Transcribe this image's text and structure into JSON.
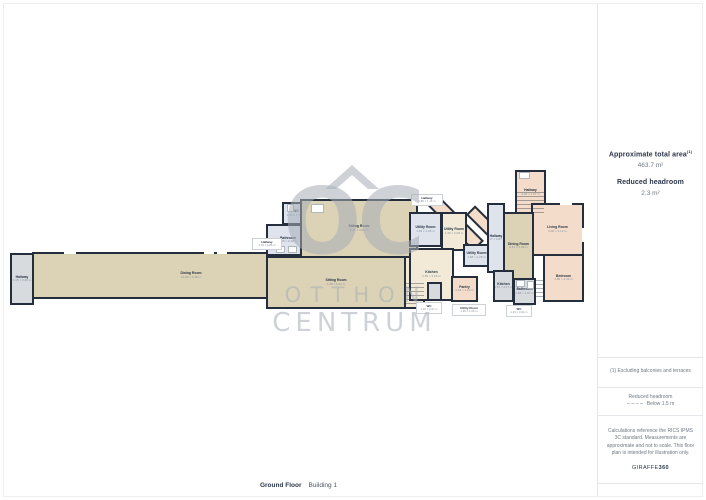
{
  "sidebar": {
    "total_area_label": "Approximate total area",
    "total_area_superscript": "(1)",
    "total_area_value": "463.7 m²",
    "reduced_headroom_label": "Reduced headroom",
    "reduced_headroom_value": "2.3 m²",
    "footnote": "(1) Excluding balconies and terraces",
    "legend_title": "Reduced headroom",
    "legend_value": "Below 1.5 m",
    "disclaimer": "Calculations reference the RICS IPMS 3C standard. Measurements are approximate and not to scale. This floor plan is intended for illustration only.",
    "brand_regular": "GIRAFFE",
    "brand_bold": "360"
  },
  "footer": {
    "floor_label": "Ground Floor",
    "building_label": "Building 1"
  },
  "watermark": {
    "initials": "OC",
    "line1": "OTTHON",
    "line2": "CENTRUM"
  },
  "floorplan": {
    "wall_color": "#242e3d",
    "fills": {
      "tan": "#dcd3b6",
      "blue": "#dee3ec",
      "gray": "#d8dbde",
      "cream": "#f2ead6",
      "pink": "#f3dcc9",
      "dkpeach": "#d3a890"
    },
    "rooms": [
      {
        "name": "diagonal-hallway-1",
        "label": "",
        "dims": "",
        "x": 424,
        "y": 216,
        "w": 64,
        "h": 15,
        "fill": "pink",
        "rot": 45,
        "z": 0
      },
      {
        "name": "diagonal-hallway-2",
        "label": "",
        "dims": "",
        "x": 462,
        "y": 224,
        "w": 58,
        "h": 13,
        "fill": "pink",
        "rot": 45,
        "z": 0
      },
      {
        "name": "hallway-far-left",
        "label": "Hallway",
        "dims": "1.05 × 3.29 m",
        "x": 10,
        "y": 253,
        "w": 24,
        "h": 52,
        "fill": "gray"
      },
      {
        "name": "corridor-long",
        "label": "Dining Room",
        "dims": "21.05 × 3.48 m",
        "x": 32,
        "y": 252,
        "w": 238,
        "h": 47,
        "fill": "tan",
        "lox": 40
      },
      {
        "name": "wc-left",
        "label": "WC",
        "dims": "2.06 × 1.72 m",
        "x": 282,
        "y": 202,
        "w": 28,
        "h": 23,
        "fill": "blue"
      },
      {
        "name": "bathroom-left",
        "label": "Bathroom",
        "dims": "3.45 × 2.48 m",
        "x": 266,
        "y": 224,
        "w": 44,
        "h": 32,
        "fill": "blue"
      },
      {
        "name": "shower-left",
        "label": "",
        "dims": "",
        "x": 309,
        "y": 202,
        "w": 17,
        "h": 23,
        "fill": "gray"
      },
      {
        "name": "closet-left",
        "label": "",
        "dims": "",
        "x": 309,
        "y": 224,
        "w": 17,
        "h": 16,
        "fill": "dkpeach"
      },
      {
        "name": "sitting-room",
        "label": "Sitting Room",
        "dims": "6.21 × 4.90 m",
        "x": 300,
        "y": 199,
        "w": 118,
        "h": 59,
        "fill": "tan"
      },
      {
        "name": "sitting-room-lower",
        "label": "Sitting Room",
        "dims": "4.38 × 5.42 m",
        "x": 266,
        "y": 256,
        "w": 140,
        "h": 53,
        "fill": "tan"
      },
      {
        "name": "stair-hall-center",
        "label": "",
        "dims": "",
        "x": 404,
        "y": 256,
        "w": 21,
        "h": 53,
        "fill": "cream"
      },
      {
        "name": "utility-room-1",
        "label": "Utility Room",
        "dims": "1.83 × 1.95 m",
        "x": 409,
        "y": 212,
        "w": 33,
        "h": 35,
        "fill": "blue"
      },
      {
        "name": "utility-room-2",
        "label": "Utility Room",
        "dims": "1.36 × 2.08 m",
        "x": 441,
        "y": 212,
        "w": 26,
        "h": 39,
        "fill": "cream"
      },
      {
        "name": "utility-room-3",
        "label": "Utility Room",
        "dims": "1.58 × 1.28 m",
        "x": 463,
        "y": 244,
        "w": 27,
        "h": 23,
        "fill": "blue"
      },
      {
        "name": "kitchen-center",
        "label": "Kitchen",
        "dims": "2.55 × 3.26 m",
        "x": 409,
        "y": 248,
        "w": 45,
        "h": 53,
        "fill": "cream"
      },
      {
        "name": "pantry",
        "label": "Pantry",
        "dims": "1.18 × 1.10 m",
        "x": 451,
        "y": 276,
        "w": 27,
        "h": 26,
        "fill": "pink"
      },
      {
        "name": "wc-center",
        "label": "",
        "dims": "",
        "x": 427,
        "y": 282,
        "w": 15,
        "h": 19,
        "fill": "gray"
      },
      {
        "name": "hallway-top-right",
        "label": "Hallway",
        "dims": "2.05 × 1.97 m",
        "x": 515,
        "y": 170,
        "w": 31,
        "h": 45,
        "fill": "pink"
      },
      {
        "name": "living-room-right",
        "label": "Living Room",
        "dims": "5.00 × 4.12 m",
        "x": 531,
        "y": 203,
        "w": 53,
        "h": 53,
        "fill": "pink"
      },
      {
        "name": "bedroom",
        "label": "Bedroom",
        "dims": "4.86 × 4.43 m",
        "x": 543,
        "y": 254,
        "w": 41,
        "h": 48,
        "fill": "pink"
      },
      {
        "name": "dining-room-right",
        "label": "Dining Room",
        "dims": "2.41 × 4.09 m",
        "x": 503,
        "y": 212,
        "w": 31,
        "h": 68,
        "fill": "tan"
      },
      {
        "name": "hallway-right",
        "label": "Hallway",
        "dims": "1.17 × 6.87 m",
        "x": 487,
        "y": 203,
        "w": 18,
        "h": 70,
        "fill": "blue"
      },
      {
        "name": "kitchen-right",
        "label": "Kitchen",
        "dims": "1.57 × 2.17 m",
        "x": 493,
        "y": 270,
        "w": 21,
        "h": 32,
        "fill": "gray"
      },
      {
        "name": "bathroom-right",
        "label": "Bathroom",
        "dims": "1.68 × 1.87 m",
        "x": 513,
        "y": 278,
        "w": 23,
        "h": 27,
        "fill": "gray"
      }
    ],
    "callouts": [
      {
        "label": "Hallway",
        "dims": "1.85 × 1.16 m",
        "x": 411,
        "y": 194,
        "w": 32,
        "h": 12
      },
      {
        "label": "Hallway",
        "dims": "1.94 × 0.86 m",
        "x": 252,
        "y": 238,
        "w": 30,
        "h": 12
      },
      {
        "label": "WC",
        "dims": "1.16 × 0.97 m",
        "x": 416,
        "y": 302,
        "w": 26,
        "h": 12
      },
      {
        "label": "Utility Room",
        "dims": "1.96 × 1.06 m",
        "x": 452,
        "y": 304,
        "w": 34,
        "h": 12
      },
      {
        "label": "WC",
        "dims": "1.33 × 0.94 m",
        "x": 506,
        "y": 305,
        "w": 26,
        "h": 12
      }
    ],
    "gaps": [
      {
        "x": 64,
        "y": 250,
        "w": 12,
        "h": 4
      },
      {
        "x": 204,
        "y": 250,
        "w": 10,
        "h": 4
      },
      {
        "x": 217,
        "y": 250,
        "w": 10,
        "h": 4
      },
      {
        "x": 560,
        "y": 201,
        "w": 12,
        "h": 4
      },
      {
        "x": 582,
        "y": 228,
        "w": 4,
        "h": 14
      }
    ],
    "fixtures": [
      {
        "x": 276,
        "y": 246,
        "w": 9,
        "h": 7
      },
      {
        "x": 288,
        "y": 246,
        "w": 9,
        "h": 7
      },
      {
        "x": 287,
        "y": 204,
        "w": 7,
        "h": 8
      },
      {
        "x": 311,
        "y": 204,
        "w": 13,
        "h": 9
      },
      {
        "x": 516,
        "y": 280,
        "w": 9,
        "h": 7
      },
      {
        "x": 527,
        "y": 281,
        "w": 7,
        "h": 8
      },
      {
        "x": 519,
        "y": 172,
        "w": 11,
        "h": 7
      }
    ],
    "stairs": [
      {
        "x": 405,
        "y": 283,
        "w": 19,
        "h": 24
      },
      {
        "x": 517,
        "y": 192,
        "w": 27,
        "h": 21
      },
      {
        "x": 536,
        "y": 280,
        "w": 9,
        "h": 20
      }
    ]
  }
}
